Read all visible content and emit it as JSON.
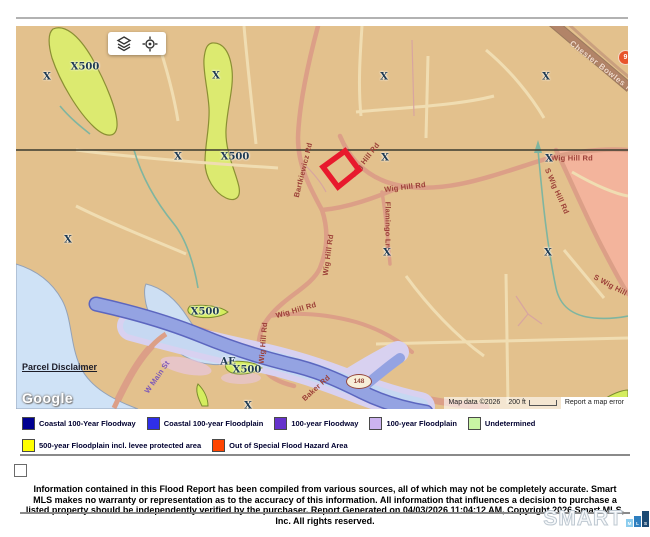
{
  "map": {
    "parcel_disclaimer": "Parcel Disclaimer",
    "google": "Google",
    "attribution": {
      "map_data": "Map data ©2026",
      "scale_label": "200 ft",
      "report_error": "Report a map error"
    },
    "shields": [
      {
        "route": "9"
      },
      {
        "route": "148"
      }
    ],
    "zone_labels": [
      {
        "t": "X500",
        "x": 69,
        "y": 41
      },
      {
        "t": "X",
        "x": 31,
        "y": 51
      },
      {
        "t": "X",
        "x": 200,
        "y": 50
      },
      {
        "t": "X",
        "x": 368,
        "y": 51
      },
      {
        "t": "X",
        "x": 530,
        "y": 51
      },
      {
        "t": "X",
        "x": 162,
        "y": 131
      },
      {
        "t": "X500",
        "x": 219,
        "y": 131
      },
      {
        "t": "X",
        "x": 369,
        "y": 132
      },
      {
        "t": "X",
        "x": 533,
        "y": 133
      },
      {
        "t": "X",
        "x": 52,
        "y": 214
      },
      {
        "t": "X",
        "x": 371,
        "y": 227
      },
      {
        "t": "X",
        "x": 532,
        "y": 227
      },
      {
        "t": "X500",
        "x": 189,
        "y": 286
      },
      {
        "t": "AE",
        "x": 212,
        "y": 336
      },
      {
        "t": "X500",
        "x": 231,
        "y": 344
      },
      {
        "t": "X",
        "x": 232,
        "y": 380
      }
    ],
    "road_labels": [
      {
        "t": "Bartkiewicz Rd",
        "x": 287,
        "y": 144,
        "r": -76,
        "c": ""
      },
      {
        "t": "Wig Hill Rd",
        "x": 349,
        "y": 134,
        "r": -52,
        "c": ""
      },
      {
        "t": "Wig Hill Rd",
        "x": 389,
        "y": 161,
        "r": -7,
        "c": ""
      },
      {
        "t": "Flamingo Ln",
        "x": 372,
        "y": 199,
        "r": 90,
        "c": ""
      },
      {
        "t": "Wig Hill Rd",
        "x": 312,
        "y": 229,
        "r": -82,
        "c": ""
      },
      {
        "t": "Wig Hill Rd",
        "x": 280,
        "y": 284,
        "r": -16,
        "c": ""
      },
      {
        "t": "Wig Hill Rd",
        "x": 247,
        "y": 317,
        "r": -85,
        "c": ""
      },
      {
        "t": "Baker Rd",
        "x": 300,
        "y": 362,
        "r": -42,
        "c": ""
      },
      {
        "t": "W Main St",
        "x": 141,
        "y": 351,
        "r": -55,
        "c": "purple"
      },
      {
        "t": "Wig Hill Rd",
        "x": 556,
        "y": 132,
        "r": 0,
        "c": ""
      },
      {
        "t": "S Wig Hill Rd",
        "x": 541,
        "y": 165,
        "r": 66,
        "c": ""
      },
      {
        "t": "S Wig Hill Rd",
        "x": 600,
        "y": 262,
        "r": 28,
        "c": ""
      },
      {
        "t": "Chester Bowles Hwy",
        "x": 590,
        "y": 44,
        "r": 38,
        "c": "hwy"
      }
    ],
    "colors": {
      "background": "#e3c18d",
      "flood_500yr_zone": "#dcea70",
      "floodway_band": "#94a3e2",
      "floodplain_band": "#d8d1f0",
      "water": "#cfe2f6",
      "pink_zone": "#f3b49c",
      "parcel_outline": "#e8192d",
      "boundary_line": "#3a3a2e"
    }
  },
  "legend": {
    "rows": [
      [
        {
          "label": "Coastal 100-Year Floodway",
          "color": "#000090"
        },
        {
          "label": "Coastal 100-year Floodplain",
          "color": "#2f2fe8"
        },
        {
          "label": "100-year Floodway",
          "color": "#6633cc"
        },
        {
          "label": "100-year Floodplain",
          "color": "#ccb3f0"
        },
        {
          "label": "Undetermined",
          "color": "#c8f4a4"
        }
      ],
      [
        {
          "label": "500-year Floodplain incl. levee protected area",
          "color": "#ffff00"
        },
        {
          "label": "Out of Special Flood Hazard Area",
          "color": "#ff4500"
        }
      ]
    ]
  },
  "footer": {
    "checkbox_checked": false,
    "disclaimer": "Information contained in this Flood Report has been compiled from various sources, all of which may not be completely accurate. Smart MLS makes no warranty or representation as to the accuracy of this information. All information that influences a decision to purchase a listed property should be independently verified by the purchaser. Report Generated on 04/03/2026 11:04:12 AM, Copyright 2026 Smart MLS, Inc. All rights reserved."
  },
  "brand": {
    "wordmark": "SMART",
    "squares": [
      {
        "letter": "M",
        "color": "#8ccdee",
        "h": 8
      },
      {
        "letter": "L",
        "color": "#2e7fbf",
        "h": 11
      },
      {
        "letter": "S",
        "color": "#1b4a74",
        "h": 16
      }
    ]
  }
}
